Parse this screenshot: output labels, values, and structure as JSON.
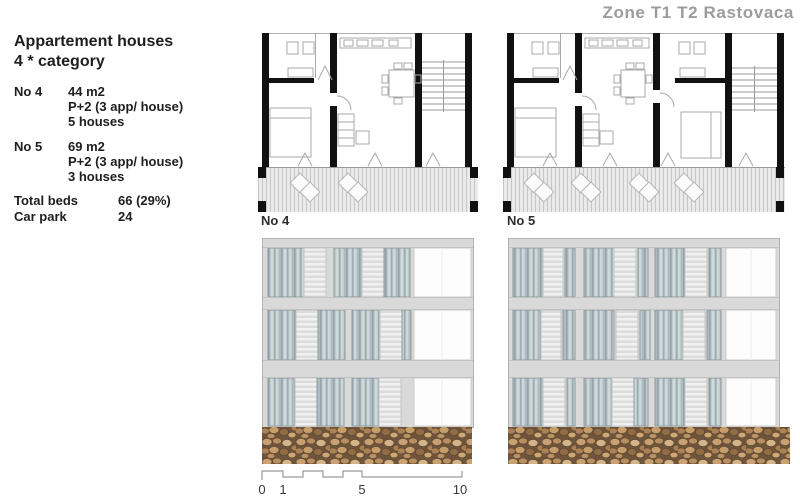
{
  "page": {
    "title": "Zone T1 T2 Rastovaca"
  },
  "info": {
    "heading_line1": "Appartement houses",
    "heading_line2": "4 * category",
    "units": [
      {
        "label": "No 4",
        "area": "44 m2",
        "config": "P+2 (3 app/ house)",
        "houses": "5 houses"
      },
      {
        "label": "No 5",
        "area": "69 m2",
        "config": "P+2 (3 app/ house)",
        "houses": "3 houses"
      }
    ],
    "totals": [
      {
        "label": "Total beds",
        "value": "66 (29%)"
      },
      {
        "label": "Car park",
        "value": "24"
      }
    ]
  },
  "plans": {
    "plan4_label": "No 4",
    "plan5_label": "No 5"
  },
  "scale_bar": {
    "tick0": "0",
    "tick1": "1",
    "tick5": "5",
    "tick10": "10"
  },
  "colors": {
    "title_gray": "#9c9c9c",
    "wall_black": "#111111",
    "facade_gray": "#d9d9d9",
    "glass_blue": "#aebcc0",
    "shutter_white": "#eeeeee",
    "stone_brown": "#b08a5e",
    "deck_gray": "#eaeaea"
  }
}
